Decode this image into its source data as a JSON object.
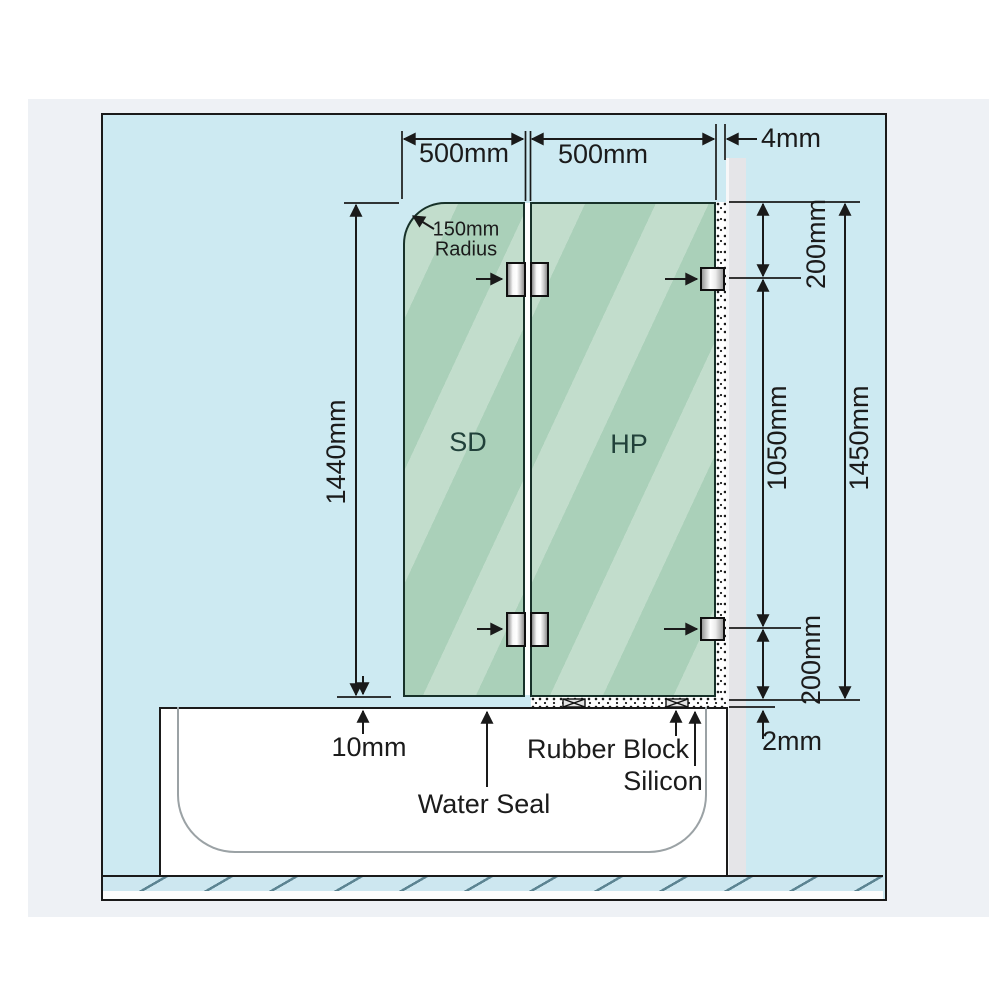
{
  "labels": {
    "dim_width_left": "500mm",
    "dim_width_right": "500mm",
    "dim_wall_gap": "4mm",
    "radius_line1": "150mm",
    "radius_line2": "Radius",
    "dim_height_left": "1440mm",
    "dim_right_top": "200mm",
    "dim_right_middle": "1050mm",
    "dim_right_total": "1450mm",
    "dim_right_bottom": "200mm",
    "dim_bottom_gap": "10mm",
    "dim_silicon_thickness": "2mm",
    "panel_left": "SD",
    "panel_right": "HP",
    "water_seal": "Water Seal",
    "rubber_block": "Rubber Block",
    "silicon": "Silicon"
  },
  "colors": {
    "page_background": "#ffffff",
    "panel_background": "#eef1f5",
    "diagram_background": "#cdeaf2",
    "glass_green": "#a7ceb6",
    "glass_streak": "#c6dfce",
    "wall_gray": "#e5e5e8",
    "line_black": "#1a1a1a",
    "tub_white": "#ffffff"
  }
}
